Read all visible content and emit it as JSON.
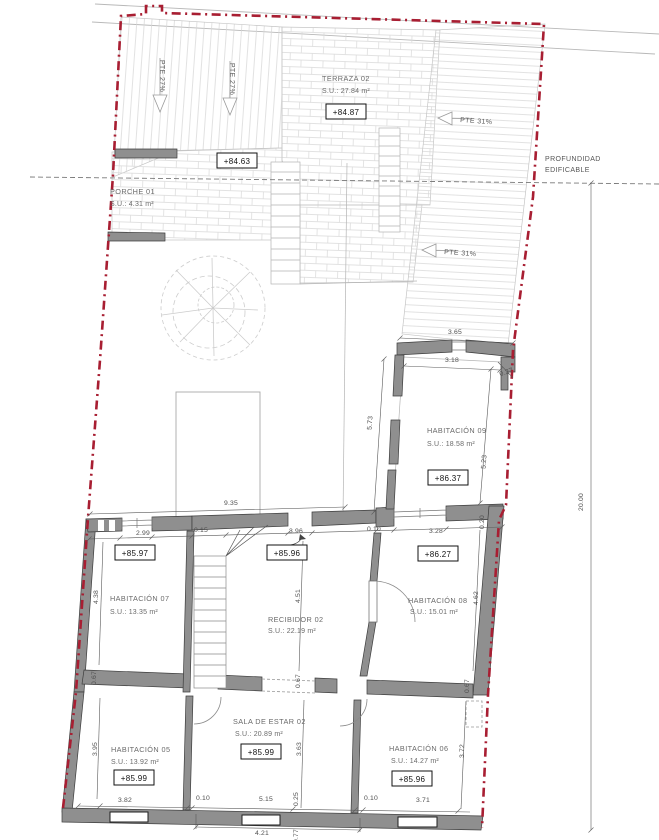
{
  "annotations": {
    "profundidad_1": "PROFUNDIDAD",
    "profundidad_2": "EDIFICABLE"
  },
  "slopes": {
    "pte27_1": "PTE 27%",
    "pte27_2": "PTE 27%",
    "pte31_1": "PTE 31%",
    "pte31_2": "PTE 31%"
  },
  "rooms": {
    "terraza": {
      "name": "TERRAZA 02",
      "area": "S.U.: 27.84 m²"
    },
    "porche": {
      "name": "PORCHE 01",
      "area": "S.U.: 4.31 m²"
    },
    "hab09": {
      "name": "HABITACIÓN 09",
      "area": "S.U.: 18.58 m²"
    },
    "hab07": {
      "name": "HABITACIÓN 07",
      "area": "S.U.: 13.35 m²"
    },
    "recibidor": {
      "name": "RECIBIDOR 02",
      "area": "S.U.: 22.19 m²"
    },
    "hab08": {
      "name": "HABITACIÓN 08",
      "area": "S.U.: 15.01 m²"
    },
    "hab05": {
      "name": "HABITACIÓN 05",
      "area": "S.U.: 13.92 m²"
    },
    "sala": {
      "name": "SALA DE ESTAR 02",
      "area": "S.U.: 20.89 m²"
    },
    "hab06": {
      "name": "HABITACIÓN 06",
      "area": "S.U.: 14.27 m²"
    }
  },
  "levels": {
    "terraza": "+84.87",
    "porche": "+84.63",
    "hab09": "+86.37",
    "hab07": "+85.97",
    "recibidor": "+85.96",
    "hab08": "+86.27",
    "hab05": "+85.99",
    "sala": "+85.99",
    "hab06": "+85.96"
  },
  "dims": {
    "w365": "3.65",
    "w318": "3.18",
    "j027": "0.27",
    "v573": "5.73",
    "v523": "5.23",
    "total": "20.00",
    "w935": "9.35",
    "c299": "2.99",
    "c015": "0.15",
    "c396": "3.96",
    "c010": "0.10",
    "c328": "3.28",
    "v020": "0.20",
    "v438": "4.38",
    "v451": "4.51",
    "v462": "4.62",
    "v067l": "0.67",
    "v067c": "0.67",
    "v067r": "0.67",
    "v395": "3.95",
    "v363": "3.63",
    "v372": "3.72",
    "b382": "3.82",
    "b010a": "0.10",
    "b515": "5.15",
    "v025": "0.25",
    "b010b": "0.10",
    "b371": "3.71",
    "b421": "4.21",
    "v077": "0.77"
  },
  "colors": {
    "boundary": "#a81e32",
    "wall": "#8f8f8f",
    "hatch": "#d6d6d6"
  }
}
